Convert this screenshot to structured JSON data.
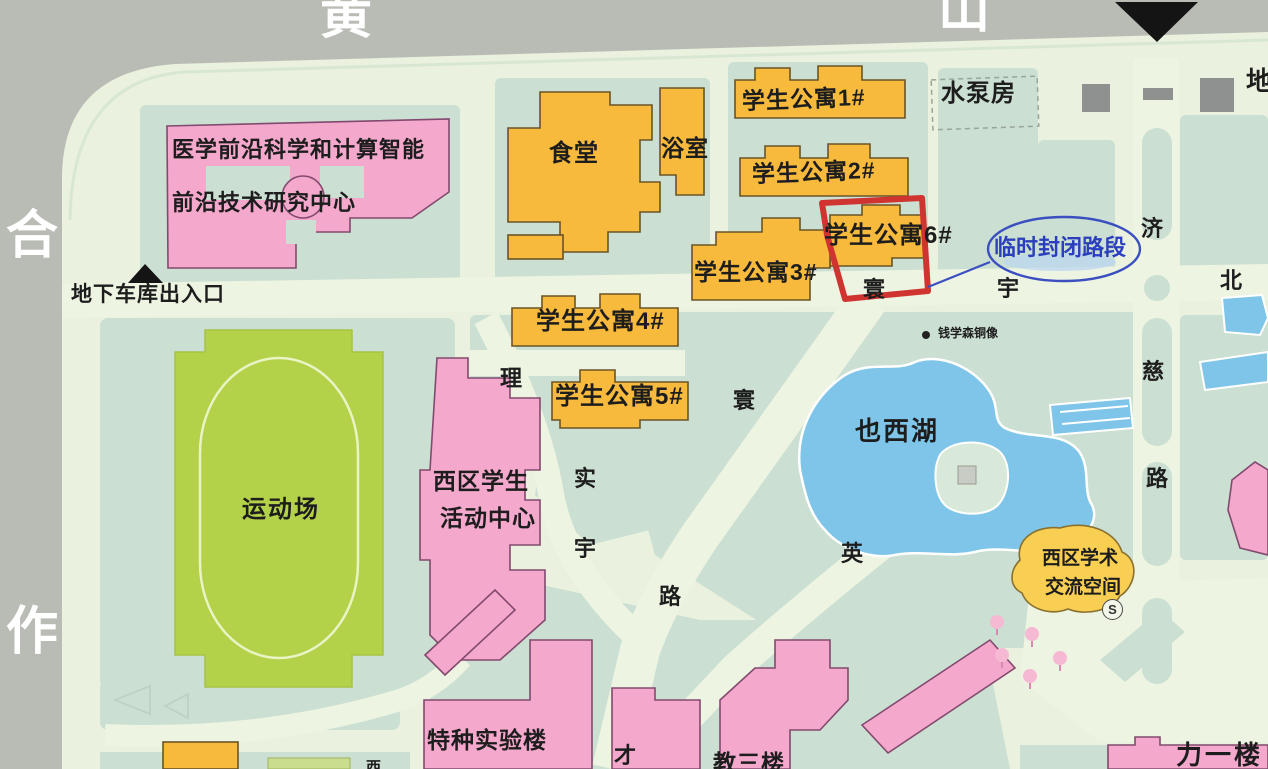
{
  "map": {
    "border_roads": {
      "top": [
        "黄",
        "山"
      ],
      "left": [
        "合",
        "作"
      ]
    },
    "buildings": {
      "research_center_line1": "医学前沿科学和计算智能",
      "research_center_line2": "前沿技术研究中心",
      "canteen": "食堂",
      "bathhouse": "浴室",
      "apartment1": "学生公寓1#",
      "apartment2": "学生公寓2#",
      "apartment3": "学生公寓3#",
      "apartment4": "学生公寓4#",
      "apartment5": "学生公寓5#",
      "apartment6": "学生公寓6#",
      "pump_house": "水泵房",
      "sports_field": "运动场",
      "student_center_line1": "西区学生",
      "student_center_line2": "活动中心",
      "academic_space_line1": "西区学术",
      "academic_space_line2": "交流空间",
      "special_lab": "特种实验楼",
      "teaching_bldg3": "教三楼",
      "li_yi_building": "力一楼"
    },
    "landmarks": {
      "lake": "也西湖",
      "statue": "钱学森铜像",
      "garage_entrance": "地下车库出入口",
      "metro_partial": "地",
      "xi_partial": "西",
      "s_badge": "S"
    },
    "road_chars": {
      "li": "理",
      "shi": "实",
      "yu": "宇",
      "lu": "路",
      "huan_diag": "寰",
      "huan": "寰",
      "yu2": "宇",
      "bei": "北",
      "ji": "济",
      "ci": "慈",
      "lu2": "路",
      "ying": "英",
      "cai": "才"
    },
    "annotations": {
      "closed_road": "临时封闭路段"
    },
    "colors": {
      "road_gray": "#b9bcb4",
      "ground_light": "#eaf1de",
      "lawn_green": "#cbdfd2",
      "water_blue": "#7fc5e9",
      "field_green": "#b3d149",
      "building_orange": "#f8ba3d",
      "building_pink": "#f3a8cc",
      "accent_red": "#cf3430",
      "annotation_blue": "#3347bd"
    }
  }
}
